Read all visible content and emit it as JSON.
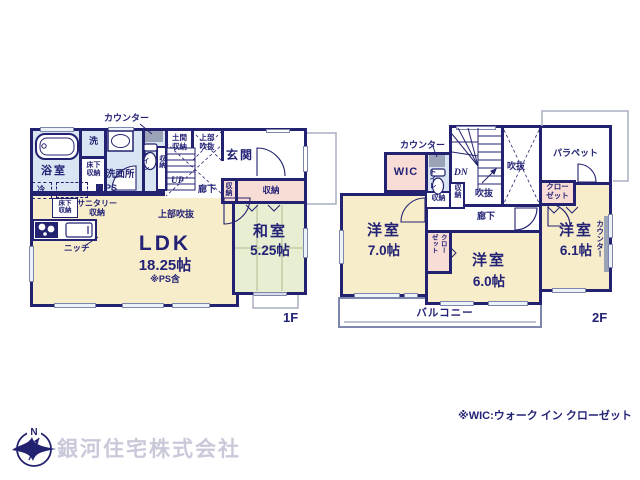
{
  "f1": {
    "floor": "1F",
    "counter": "カウンター",
    "bath": "浴室",
    "wash": "洗",
    "washroom": "洗面所",
    "underfloor_l1": "床下",
    "underfloor_l2": "収納",
    "toilet": "トイレ",
    "storage": "収納",
    "doma_l1": "土間",
    "doma_l2": "収納",
    "void_l1": "上部",
    "void_l2": "吹抜",
    "entrance": "玄関",
    "up": "UP",
    "hall": "廊下",
    "void_mid": "上部吹抜",
    "fridge": "冷",
    "sanitary_l1": "サニタリー",
    "sanitary_l2": "収納",
    "ps": "PS",
    "niche": "ニッチ",
    "ldk": "LDK",
    "ldk_size": "18.25帖",
    "ldk_note": "※PS含",
    "washitsu": "和室",
    "washitsu_size": "5.25帖"
  },
  "f2": {
    "floor": "2F",
    "counter": "カウンター",
    "wic": "WIC",
    "toilet": "トイレ",
    "dn": "DN",
    "void_small": "吹抜",
    "void_big": "吹抜",
    "parapet": "パラペット",
    "storage": "収納",
    "hall": "廊下",
    "closet_l1": "クロー",
    "closet_l2": "ゼット",
    "bed1": "洋室",
    "bed1_size": "7.0帖",
    "bed2": "洋室",
    "bed2_size": "6.0帖",
    "bed3": "洋室",
    "bed3_size": "6.1帖",
    "counter_side": "カウンター",
    "balcony": "バルコニー"
  },
  "footer": {
    "note": "※WIC:ウォーク イン クローゼット",
    "company": "銀河住宅株式会社",
    "north": "N"
  },
  "colors": {
    "wall": "#232270",
    "room_beige": "#f8edcb",
    "tatami_green": "#e7eed2",
    "wet_blue": "#d9e5f2",
    "closet_pink": "#f8dcd6",
    "counter_gray": "#9aa3b8",
    "eave_gray": "#a8aec2",
    "logo_text": "#c9c9da"
  }
}
